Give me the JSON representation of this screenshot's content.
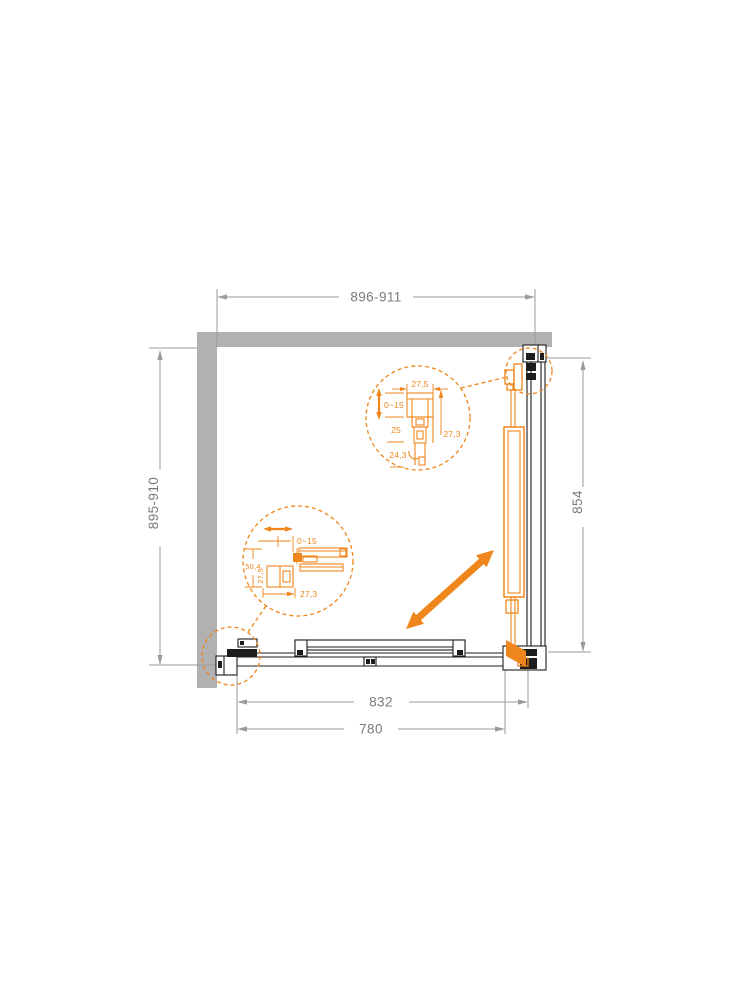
{
  "drawing_title": "corner-shower-enclosure-plan",
  "dims": {
    "width_top": "896-911",
    "depth_left": "895-910",
    "height_right": "854",
    "bottom_outer": "832",
    "bottom_inner": "780"
  },
  "detail_top": {
    "width": "27,5",
    "adjustment": "0~15",
    "depth_mid": "25",
    "depth_bottom": "24,3",
    "depth_side": "27,3"
  },
  "detail_wall": {
    "adjustment": "0~15",
    "height": "50,4",
    "width": "27,5",
    "depth": "27,3"
  },
  "colors": {
    "accent_orange": "#ef861b",
    "wall_gray": "#b1b1b1",
    "dimension_gray": "#7a7a7a",
    "line_black": "#1d1d1d"
  },
  "icons": {
    "slide_direction": "diagonal-double-arrow",
    "adjust_vertical": "vertical-double-arrow",
    "adjust_horizontal": "horizontal-double-arrow"
  }
}
